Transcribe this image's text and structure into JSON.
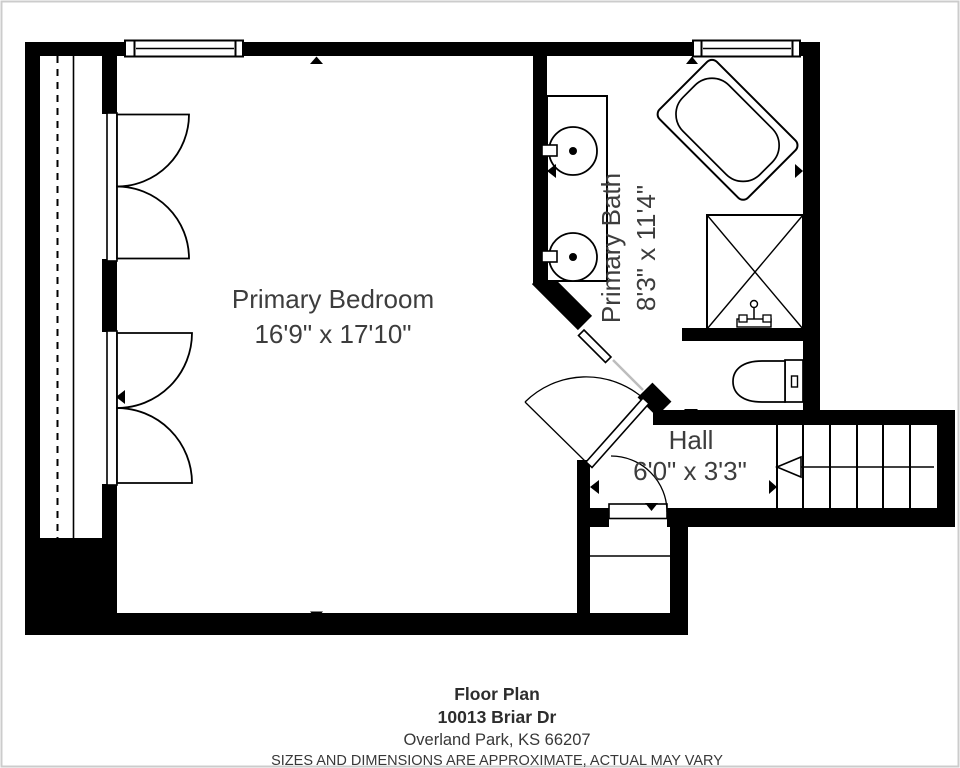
{
  "plan": {
    "rooms": [
      {
        "name": "Primary Bedroom",
        "dimensions": "16'9\" x 17'10\""
      },
      {
        "name": "Primary Bath",
        "dimensions": "8'3\" x 11'4\""
      },
      {
        "name": "Hall",
        "dimensions": "6'0\" x 3'3\""
      }
    ],
    "fixtures": [
      "bathtub",
      "shower",
      "double-vanity-sink",
      "toilet",
      "staircase",
      "bifold-closet-doors",
      "closet-rod",
      "linen-closet"
    ],
    "colors": {
      "walls": "#000000",
      "floor": "#ffffff",
      "label_text": "#3d3d3d",
      "pocket_door_track": "#bdbdbd"
    }
  },
  "footer": {
    "title": "Floor Plan",
    "address_line1": "10013 Briar Dr",
    "address_line2": "Overland Park, KS 66207",
    "disclaimer": "SIZES AND DIMENSIONS ARE APPROXIMATE, ACTUAL MAY VARY"
  }
}
